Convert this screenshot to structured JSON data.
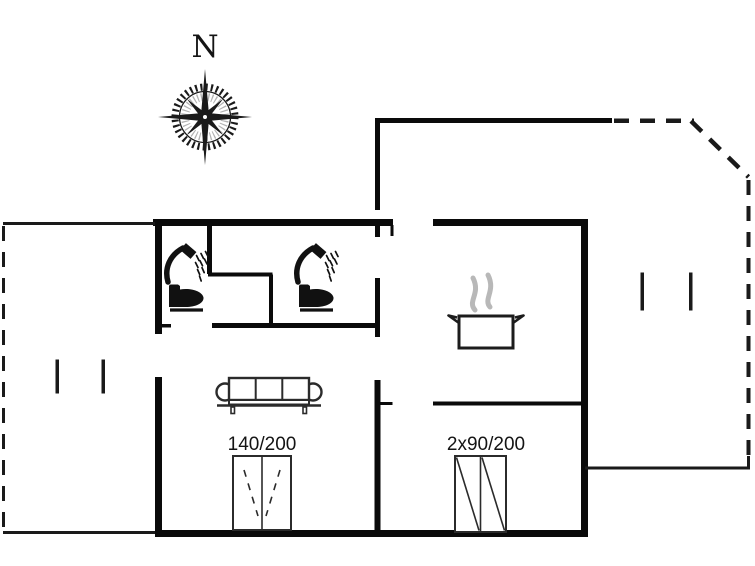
{
  "compass": {
    "north_label": "N"
  },
  "labels": {
    "double_bed": "140/200",
    "twin_beds": "2x90/200"
  },
  "colors": {
    "background": "#ffffff",
    "walls": "#0a0a0a",
    "furniture_outline": "#2b2b2b",
    "steam": "#b8b8b8",
    "text": "#141414"
  },
  "icons": [
    "compass-rose-icon",
    "shower-icon",
    "toilet-icon",
    "cooking-pot-icon",
    "steam-icon",
    "sofa-icon",
    "double-bed-icon",
    "twin-beds-icon"
  ]
}
